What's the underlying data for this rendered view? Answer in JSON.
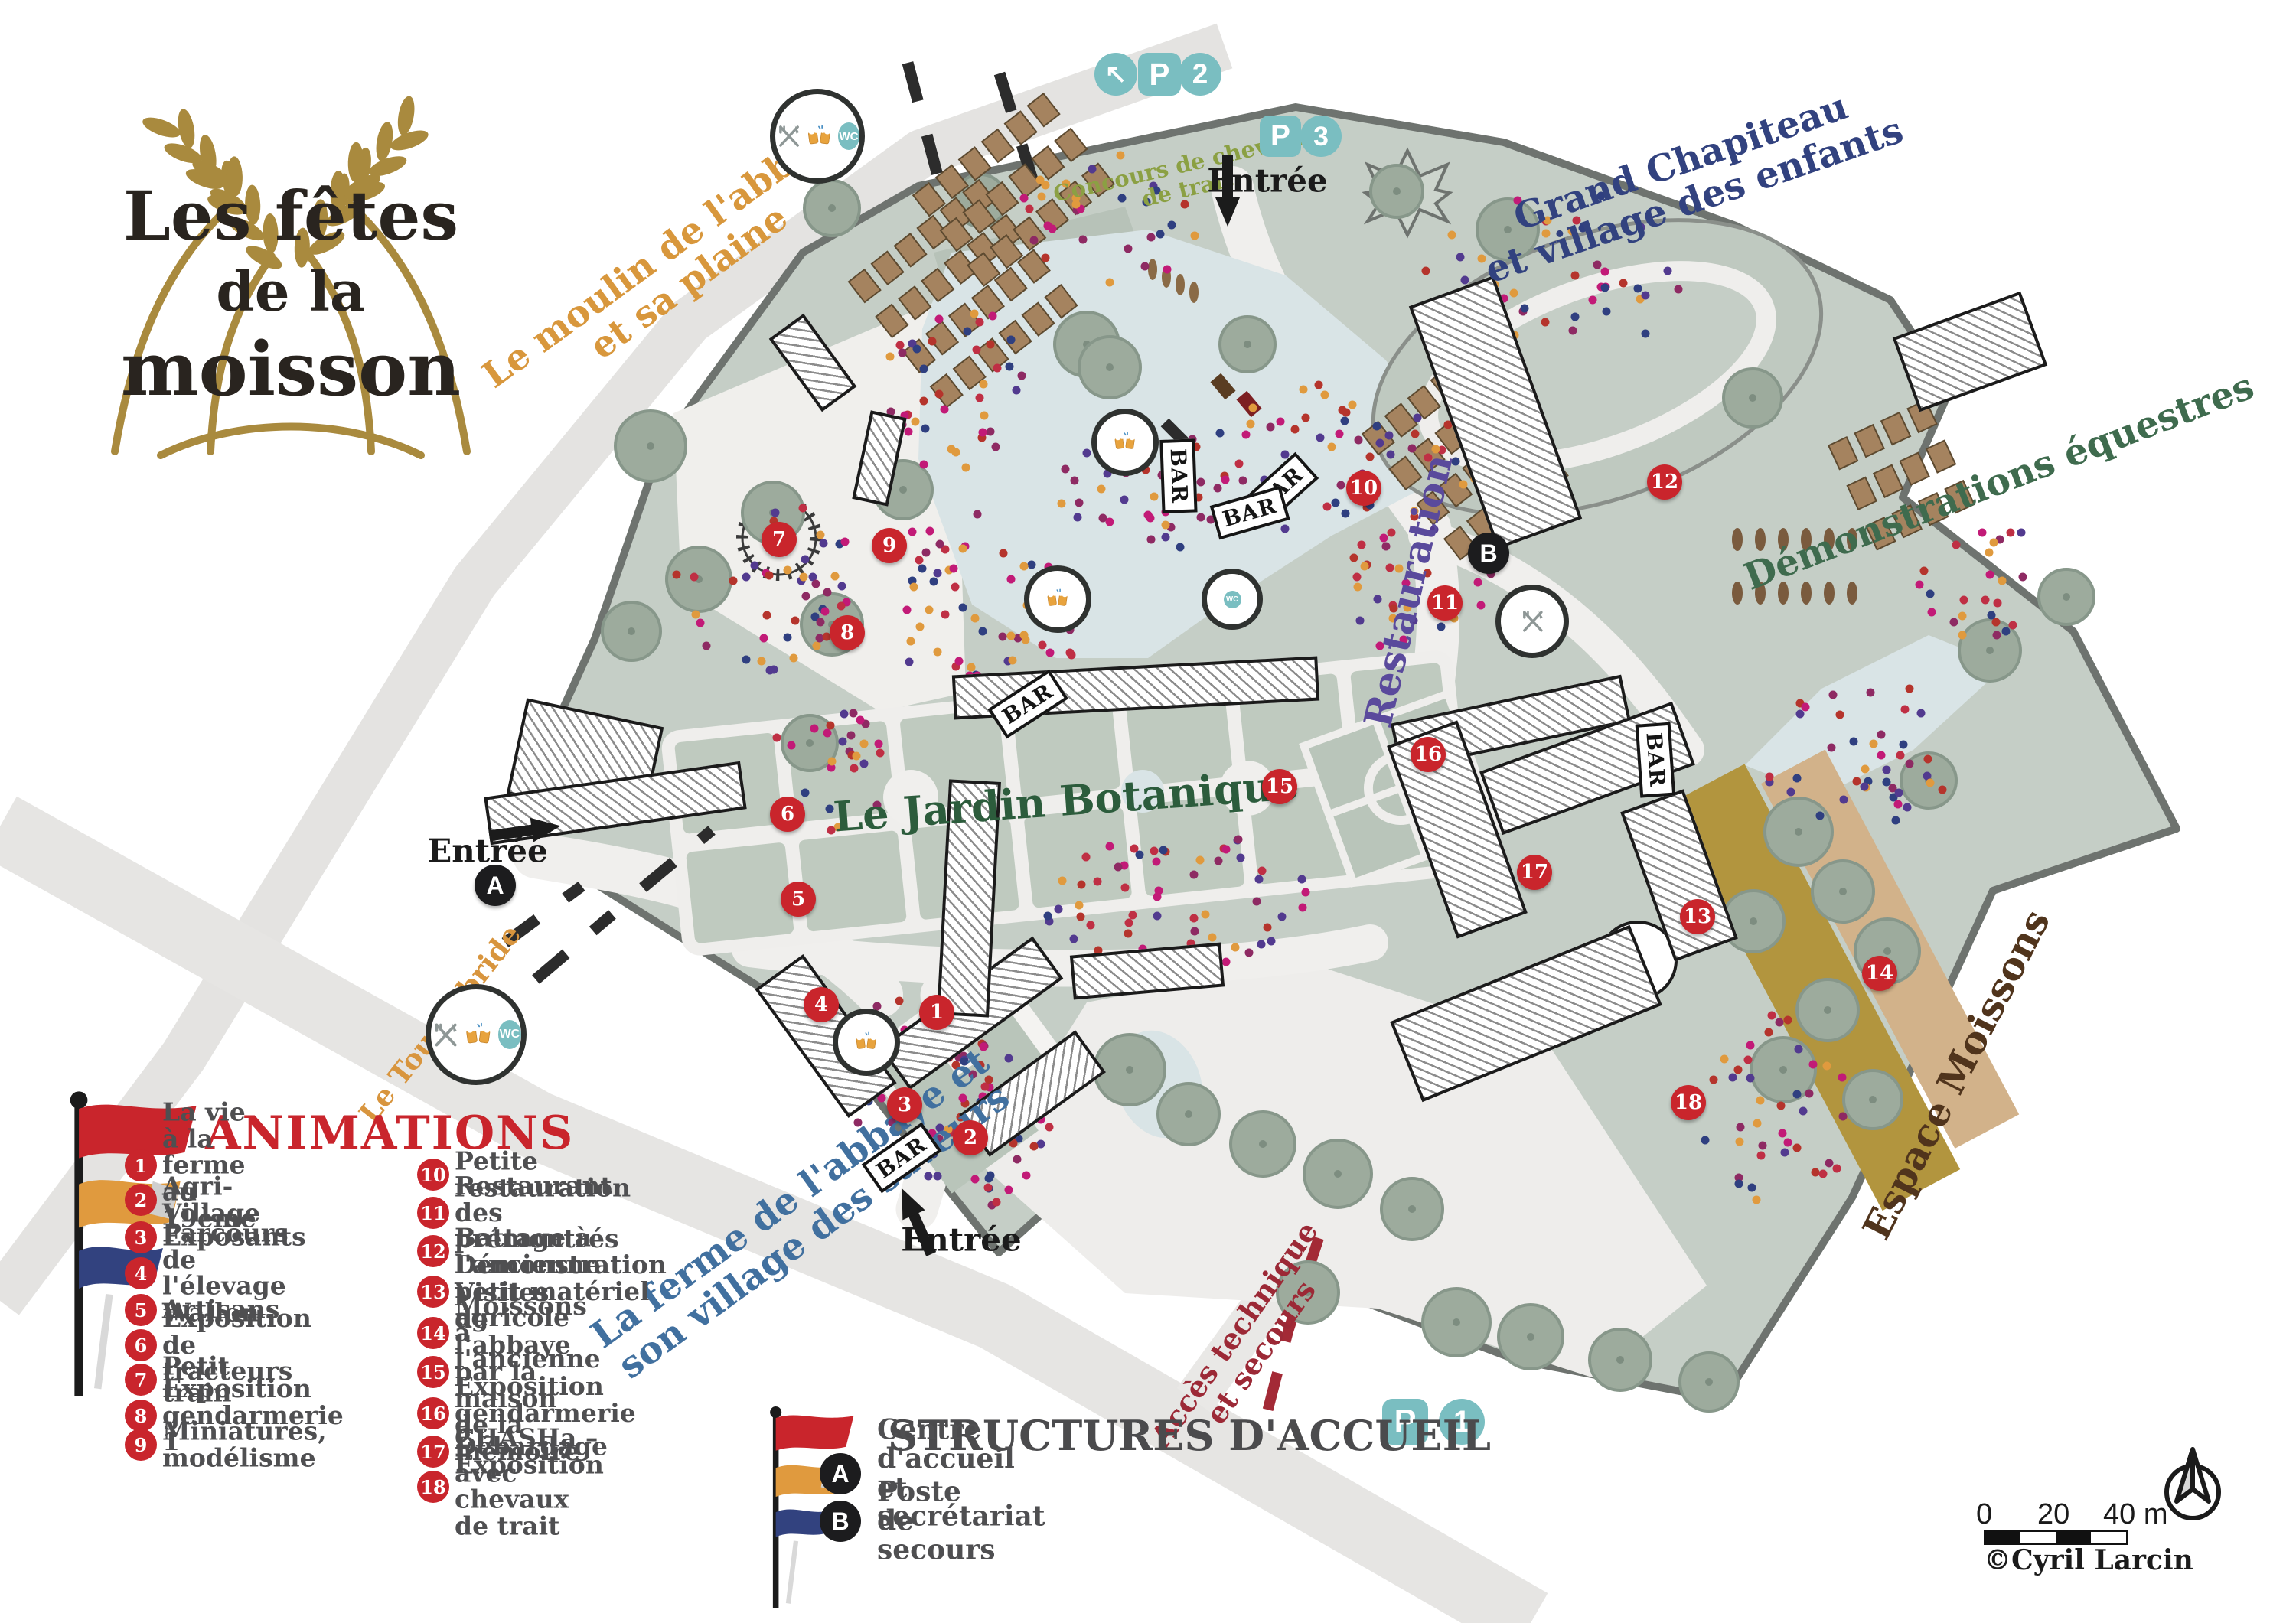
{
  "logo": {
    "line1": "Les fêtes",
    "line2": "de la",
    "line3": "moisson"
  },
  "area_labels": [
    {
      "id": "moulin",
      "lines": [
        "Le moulin de l'abbaye",
        "et sa plaine"
      ],
      "color": "#d8973c"
    },
    {
      "id": "concours",
      "lines": [
        "Concours de chevaux",
        "de trait"
      ],
      "color": "#8ba043"
    },
    {
      "id": "chapiteau",
      "lines": [
        "Grand Chapiteau",
        "et village des enfants"
      ],
      "color": "#32427f"
    },
    {
      "id": "equestre",
      "lines": [
        "Démonstrations équestres"
      ],
      "color": "#3f6b4e"
    },
    {
      "id": "restauration",
      "lines": [
        "Restauration"
      ],
      "color": "#5a4a9c"
    },
    {
      "id": "jardin",
      "lines": [
        "Le Jardin Botanique"
      ],
      "color": "#2c5c3c"
    },
    {
      "id": "ferme",
      "lines": [
        "La ferme de l'abbaye et",
        "son village des saveurs"
      ],
      "color": "#41709f"
    },
    {
      "id": "tournebride",
      "lines": [
        "Le Tournebride"
      ],
      "color": "#d8953e"
    },
    {
      "id": "moissons",
      "lines": [
        "Espace Moissons"
      ],
      "color": "#50341c"
    },
    {
      "id": "acces",
      "lines": [
        "Accès technique",
        "et secours"
      ],
      "color": "#9c2936"
    }
  ],
  "entrances": [
    {
      "id": "north",
      "label": "Entrée"
    },
    {
      "id": "west",
      "label": "Entrée"
    },
    {
      "id": "south",
      "label": "Entrée"
    }
  ],
  "parkings": [
    {
      "id": "p2",
      "letter": "P",
      "number": "2",
      "has_arrow": true,
      "arrow": "↖"
    },
    {
      "id": "p3",
      "letter": "P",
      "number": "3",
      "has_arrow": false,
      "arrow": ""
    },
    {
      "id": "p1",
      "letter": "P",
      "number": "1",
      "has_arrow": false,
      "arrow": ""
    }
  ],
  "markers": [
    "1",
    "2",
    "3",
    "4",
    "5",
    "6",
    "7",
    "8",
    "9",
    "10",
    "11",
    "12",
    "13",
    "14",
    "15",
    "16",
    "17",
    "18"
  ],
  "structure_points": [
    "A",
    "B"
  ],
  "bar_label": "BAR",
  "wc_label": "WC",
  "legend": {
    "animations_title": "ANIMATIONS",
    "items": [
      {
        "num": "1",
        "label": "La vie à la ferme au 19ème"
      },
      {
        "num": "2",
        "label": "Agri-Village"
      },
      {
        "num": "3",
        "label": "Exposants"
      },
      {
        "num": "4",
        "label": "Parcours de l'élevage Wallon"
      },
      {
        "num": "5",
        "label": "Artisans"
      },
      {
        "num": "6",
        "label": "Exposition de tracteurs"
      },
      {
        "num": "7",
        "label": "Petit train"
      },
      {
        "num": "8",
        "label": "Exposition gendarmerie 1"
      },
      {
        "num": "9",
        "label": "Miniatures, modélisme"
      },
      {
        "num": "10",
        "label": "Petite restauration"
      },
      {
        "num": "11",
        "label": "Restaurant des prémontrés"
      },
      {
        "num": "12",
        "label": "Battage à l'ancienne"
      },
      {
        "num": "13",
        "label": "Démonstration petit matériel agricole"
      },
      {
        "num": "14",
        "label": "Moissons à l'ancienne"
      },
      {
        "num": "15",
        "label": "Visites de l'abbaye par la maison\nde la mémoire"
      },
      {
        "num": "16",
        "label": "Exposition gendarmerie 2"
      },
      {
        "num": "17",
        "label": "CHASHa – Exposition"
      },
      {
        "num": "18",
        "label": "Débardage avec chevaux de trait"
      }
    ],
    "structures_title": "STRUCTURES D'ACCUEIL",
    "structures": [
      {
        "letter": "A",
        "label": "Centre d'accueil et secrétariat"
      },
      {
        "letter": "B",
        "label": "Poste de secours"
      }
    ]
  },
  "scale": {
    "t0": "0",
    "t20": "20",
    "t40": "40 m"
  },
  "credit": "©Cyril Larcin",
  "colors": {
    "teal": "#7abec1",
    "marker_red": "#c9252c",
    "ground": "#c5cec6",
    "lake": "#d9e4e6",
    "legend_red": "#c9252c",
    "text_gray": "#4f4f51"
  }
}
